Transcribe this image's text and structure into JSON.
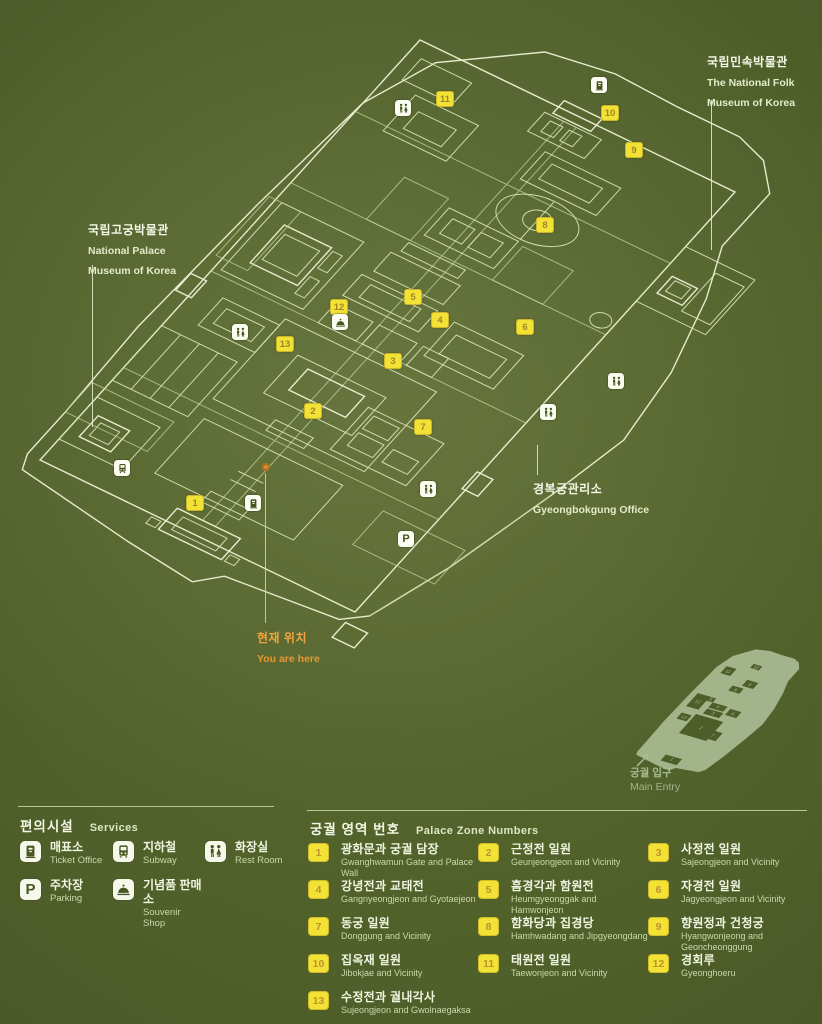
{
  "colors": {
    "background": "#50602a",
    "line": "#dce7ba",
    "marker_yellow": "#f1e235",
    "badge_white": "#fbfdf0",
    "accent_orange": "#eda63f",
    "minimap_fill": "#aabb94"
  },
  "map": {
    "labels": {
      "folk_museum_ko": "국립민속박물관",
      "folk_museum_en1": "The National Folk",
      "folk_museum_en2": "Museum of Korea",
      "palace_museum_ko": "국립고궁박물관",
      "palace_museum_en1": "National Palace",
      "palace_museum_en2": "Museum of Korea",
      "office_ko": "경복궁관리소",
      "office_en": "Gyeongbokgung Office",
      "you_are_here_ko": "현재 위치",
      "you_are_here_en": "You are here"
    },
    "markers": [
      {
        "n": "1",
        "x": 195,
        "y": 503
      },
      {
        "n": "2",
        "x": 313,
        "y": 411
      },
      {
        "n": "3",
        "x": 393,
        "y": 361
      },
      {
        "n": "4",
        "x": 440,
        "y": 320
      },
      {
        "n": "5",
        "x": 413,
        "y": 297
      },
      {
        "n": "6",
        "x": 525,
        "y": 327
      },
      {
        "n": "7",
        "x": 423,
        "y": 427
      },
      {
        "n": "8",
        "x": 545,
        "y": 225
      },
      {
        "n": "9",
        "x": 634,
        "y": 150
      },
      {
        "n": "10",
        "x": 610,
        "y": 113
      },
      {
        "n": "11",
        "x": 445,
        "y": 99
      },
      {
        "n": "12",
        "x": 339,
        "y": 307
      },
      {
        "n": "13",
        "x": 285,
        "y": 344
      }
    ],
    "badges": [
      {
        "icon": "restroom",
        "x": 403,
        "y": 108
      },
      {
        "icon": "ticket",
        "x": 599,
        "y": 85
      },
      {
        "icon": "restroom",
        "x": 240,
        "y": 332
      },
      {
        "icon": "souvenir",
        "x": 340,
        "y": 322
      },
      {
        "icon": "subway",
        "x": 122,
        "y": 468
      },
      {
        "icon": "ticket",
        "x": 253,
        "y": 503
      },
      {
        "icon": "restroom",
        "x": 428,
        "y": 489
      },
      {
        "icon": "restroom",
        "x": 548,
        "y": 412
      },
      {
        "icon": "restroom",
        "x": 616,
        "y": 381
      },
      {
        "icon": "parking",
        "x": 406,
        "y": 539
      }
    ]
  },
  "minimap": {
    "entry_ko": "궁궐 입구",
    "entry_en": "Main Entry"
  },
  "services": {
    "title_ko": "편의시설",
    "title_en": "Services",
    "items": [
      {
        "icon": "ticket",
        "ko": "매표소",
        "en": "Ticket Office"
      },
      {
        "icon": "subway",
        "ko": "지하철",
        "en": "Subway"
      },
      {
        "icon": "restroom",
        "ko": "화장실",
        "en": "Rest Room"
      },
      {
        "icon": "parking",
        "ko": "주차장",
        "en": "Parking"
      },
      {
        "icon": "souvenir",
        "ko": "기념품 판매소",
        "en": "Souvenir Shop"
      }
    ]
  },
  "zones": {
    "title_ko": "궁궐 영역 번호",
    "title_en": "Palace Zone Numbers",
    "items": [
      {
        "n": "1",
        "ko": "광화문과 궁궐 담장",
        "en": "Gwanghwamun Gate and Palace Wall"
      },
      {
        "n": "2",
        "ko": "근정전 일원",
        "en": "Geunjeongjeon and Vicinity"
      },
      {
        "n": "3",
        "ko": "사정전 일원",
        "en": "Sajeongjeon and Vicinity"
      },
      {
        "n": "4",
        "ko": "강녕전과 교태전",
        "en": "Gangnyeongjeon and Gyotaejeon"
      },
      {
        "n": "5",
        "ko": "흠경각과 함원전",
        "en": "Heumgyeonggak and Hamwonjeon"
      },
      {
        "n": "6",
        "ko": "자경전 일원",
        "en": "Jagyeongjeon and Vicinity"
      },
      {
        "n": "7",
        "ko": "동궁 일원",
        "en": "Donggung and Vicinity"
      },
      {
        "n": "8",
        "ko": "함화당과 집경당",
        "en": "Hamhwadang and Jipgyeongdang"
      },
      {
        "n": "9",
        "ko": "향원정과 건청궁",
        "en": "Hyangwonjeong and Geoncheonggung"
      },
      {
        "n": "10",
        "ko": "집옥재 일원",
        "en": "Jibokjae and Vicinity"
      },
      {
        "n": "11",
        "ko": "태원전 일원",
        "en": "Taewonjeon and Vicinity"
      },
      {
        "n": "12",
        "ko": "경회루",
        "en": "Gyeonghoeru"
      },
      {
        "n": "13",
        "ko": "수정전과 궐내각사",
        "en": "Sujeongjeon and Gwolnaegaksa"
      }
    ]
  }
}
